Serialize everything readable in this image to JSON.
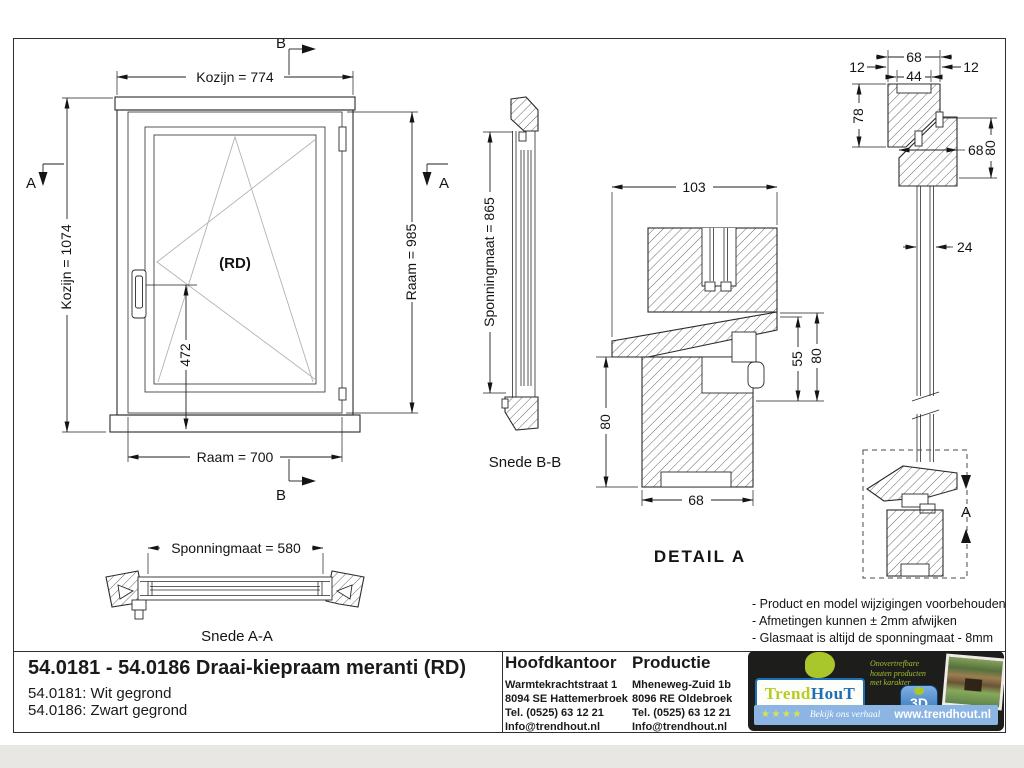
{
  "front": {
    "rd": "(RD)",
    "kozijn_w": "Kozijn = 774",
    "kozijn_h": "Kozijn = 1074",
    "raam_h": "Raam = 985",
    "raam_w": "Raam = 700",
    "handle_dim": "472",
    "a": "A",
    "b": "B"
  },
  "snede_aa": {
    "dim": "Sponningmaat = 580",
    "label": "Snede A-A"
  },
  "snede_bb": {
    "dim": "Sponningmaat = 865",
    "label": "Snede B-B"
  },
  "detail": {
    "d103": "103",
    "d80l": "80",
    "d55": "55",
    "d80r": "80",
    "d68": "68",
    "label": "DETAIL  A"
  },
  "section": {
    "d68top": "68",
    "d44": "44",
    "d12l": "12",
    "d12r": "12",
    "d78": "78",
    "d68mid": "68",
    "d80": "80",
    "d24": "24",
    "a": "A"
  },
  "notes": {
    "n1": "- Product en model wijzigingen voorbehouden",
    "n2": "- Afmetingen kunnen ± 2mm afwijken",
    "n3": "- Glasmaat is altijd de sponningmaat - 8mm"
  },
  "titleblock": {
    "title": "54.0181 - 54.0186 Draai-kiepraam meranti (RD)",
    "variant1": "54.0181: Wit gegrond",
    "variant2": "54.0186: Zwart gegrond",
    "office": {
      "heading": "Hoofdkantoor",
      "l1": "Warmtekrachtstraat 1",
      "l2": "8094 SE Hattemerbroek",
      "l3": "Tel. (0525) 63 12 21",
      "l4": "Info@trendhout.nl"
    },
    "production": {
      "heading": "Productie",
      "l1": "Mheneweg-Zuid 1b",
      "l2": "8096 RE Oldebroek",
      "l3": "Tel. (0525) 63 12 21",
      "l4": "Info@trendhout.nl"
    }
  },
  "logo": {
    "trend": "Trend",
    "hout": "HouT",
    "tag1": "Onovertrefbare",
    "tag2": "houten producten",
    "tag3": "met karakter",
    "badge": "3D",
    "stars": "★★★★",
    "script": "Bekijk ons verhaal",
    "site": "www.trendhout.nl"
  },
  "colors": {
    "line": "#2b2b2b",
    "accent_blue": "#1e6fb4",
    "accent_lime": "#a9c62b",
    "logo_bg": "#1d1d1b",
    "bar_blue": "#8db5e3",
    "strip_gray": "#e9e7e3"
  }
}
